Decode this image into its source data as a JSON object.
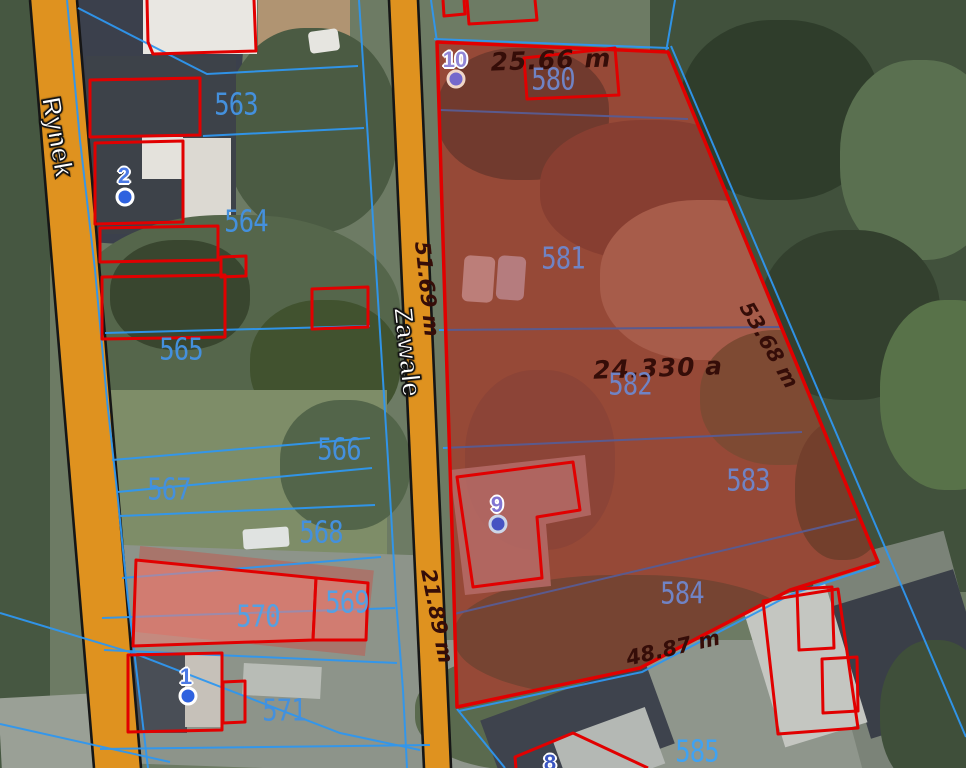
{
  "viewer": {
    "type": "cadastral-aerial-map"
  },
  "streets": {
    "left": "Rynek",
    "middle": "Zawale"
  },
  "selected_parcel": {
    "area_label": "24.330 a",
    "edge_top": "25.66 m",
    "edge_left_upper": "51.69 m",
    "edge_right": "53.68 m",
    "edge_left_lower": "21.89 m",
    "edge_bottom": "48.87 m"
  },
  "parcel_numbers": {
    "p563": "563",
    "p564": "564",
    "p565": "565",
    "p566": "566",
    "p567": "567",
    "p568": "568",
    "p569": "569",
    "p570": "570",
    "p571": "571",
    "p580": "580",
    "p581": "581",
    "p582": "582",
    "p583": "583",
    "p584": "584",
    "p585": "585"
  },
  "markers": {
    "m1": "1",
    "m2": "2",
    "m8": "8",
    "m9": "9",
    "m10": "10"
  },
  "colors": {
    "parcel_outline_red": "#e10000",
    "selection_fill": "rgba(150,8,8,0.42)",
    "boundary_blue": "#2f97f0",
    "road_orange": "#df921f",
    "parcel_label_blue": "#4490dd",
    "parcel_label_muted": "#7083c4",
    "measurement_text": "#350d08",
    "building_highlight_pink": "rgba(242,130,118,0.55)",
    "marker_blue": "#2f62df"
  }
}
